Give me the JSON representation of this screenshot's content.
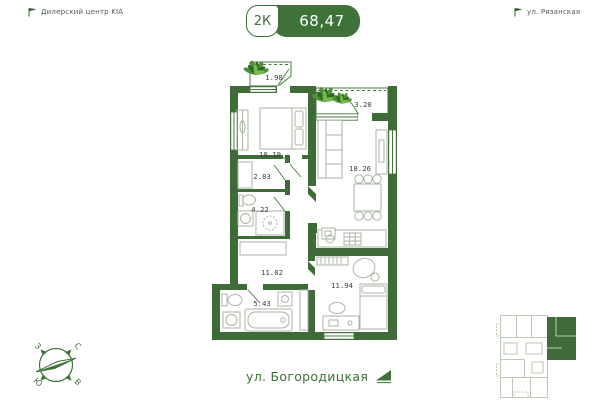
{
  "header": {
    "landmark_left": "Дилерский центр KIA",
    "landmark_right": "ул. Рязанская",
    "badge": {
      "rooms": "2К",
      "area": "68,47"
    }
  },
  "plan": {
    "areas": {
      "balcony_top": "1.98",
      "balcony_right": "3.20",
      "bedroom": "10.19",
      "kitchen_living": "18.26",
      "closet": "2.83",
      "wc": "4.22",
      "hallway": "11.02",
      "bathroom": "5.43",
      "bedroom_2": "11.94"
    }
  },
  "compass": {
    "west": "З",
    "north": "С",
    "south": "Ю",
    "east": "В"
  },
  "footer": {
    "street": "ул. Богородицкая"
  },
  "colors": {
    "accent": "#3E7239",
    "wall": "#3E6B38",
    "mini_outline": "#BCC8B6"
  }
}
